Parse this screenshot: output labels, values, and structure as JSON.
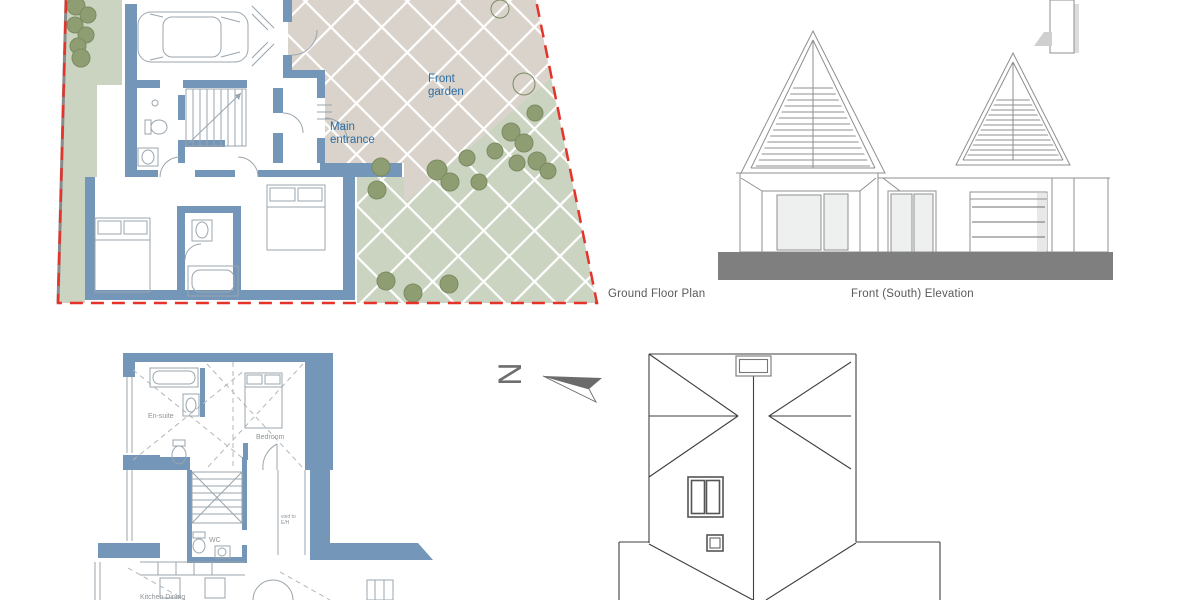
{
  "page": {
    "title": "Architectural drawing sheet"
  },
  "colors": {
    "wall_blue": "#7496b8",
    "garden_green": "#cbd3c1",
    "paving_beige": "#d9d3cb",
    "tree_fill": "#8e9d72",
    "tree_stroke": "#7b8b61",
    "boundary_red": "#e5332a",
    "boundary_under_gray": "#8a8a8a",
    "label_blue": "#2e6da4",
    "caption_gray": "#58595b",
    "annotation_gray": "#8f9498",
    "ground_gray": "#7f7f7f",
    "line_gray": "#8f8f8f",
    "roof_line": "#3f3f3f",
    "fixture_gray": "#9aa5ad",
    "glass_fill": "#eef0f0"
  },
  "ground_floor_plan": {
    "caption": "Ground Floor Plan",
    "front_garden_label": {
      "line1": "Front",
      "line2": "garden"
    },
    "main_entrance_label": {
      "line1": "Main",
      "line2": "entrance"
    }
  },
  "front_elevation": {
    "caption": "Front (South) Elevation"
  },
  "north_arrow": {
    "letter": "N"
  },
  "first_floor_plan": {
    "labels": {
      "ensuite": "En-suite",
      "bedroom": "Bedroom",
      "wc": "WC",
      "void_line1": "void to",
      "void_line2": "E/H",
      "kitchen_dining": "Kitchen Dining"
    }
  }
}
